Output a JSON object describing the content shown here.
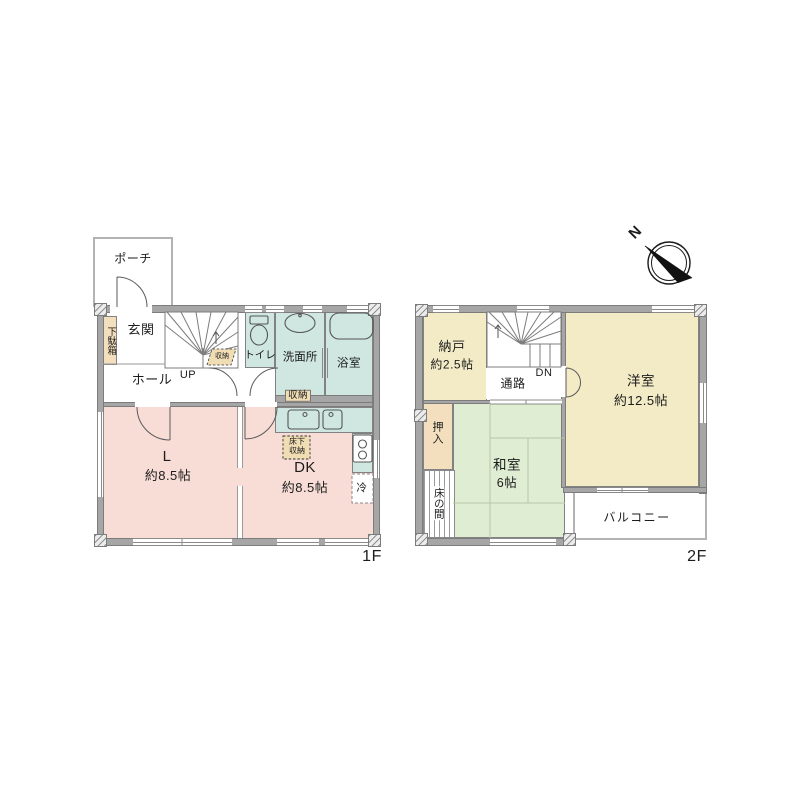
{
  "title": "2-story floor plan",
  "compass": {
    "north_label": "N"
  },
  "floor1": {
    "floor_label": "1F",
    "porch": "ポーチ",
    "shoe_cabinet": "下駄箱",
    "entrance": "玄関",
    "hall": "ホール",
    "stairs_up": "UP",
    "stairs_storage": "収納",
    "toilet": "トイレ",
    "washroom": "洗面所",
    "bathroom": "浴室",
    "storage": "収納",
    "living": {
      "name": "L",
      "size": "約8.5帖"
    },
    "dining_kitchen": {
      "name": "DK",
      "size": "約8.5帖"
    },
    "underfloor_storage": {
      "line1": "床下",
      "line2": "収納"
    },
    "refrigerator": "冷"
  },
  "floor2": {
    "floor_label": "2F",
    "storeroom": {
      "name": "納戸",
      "size": "約2.5帖"
    },
    "stairs_down": "DN",
    "passage": "通路",
    "western_room": {
      "name": "洋室",
      "size": "約12.5帖"
    },
    "closet": "押入",
    "tokonoma": "床の間",
    "japanese_room": {
      "name": "和室",
      "size": "6帖"
    },
    "balcony": "バルコニー"
  },
  "colors": {
    "wall_gray": "#a6a6a6",
    "room_pink": "#f8ddd6",
    "room_mint": "#cfe7e0",
    "room_cream": "#f2ebc6",
    "room_tatami": "#dfedd3",
    "cabinet_tan": "#f3dfbd",
    "label_tan": "#f0ddb4"
  }
}
